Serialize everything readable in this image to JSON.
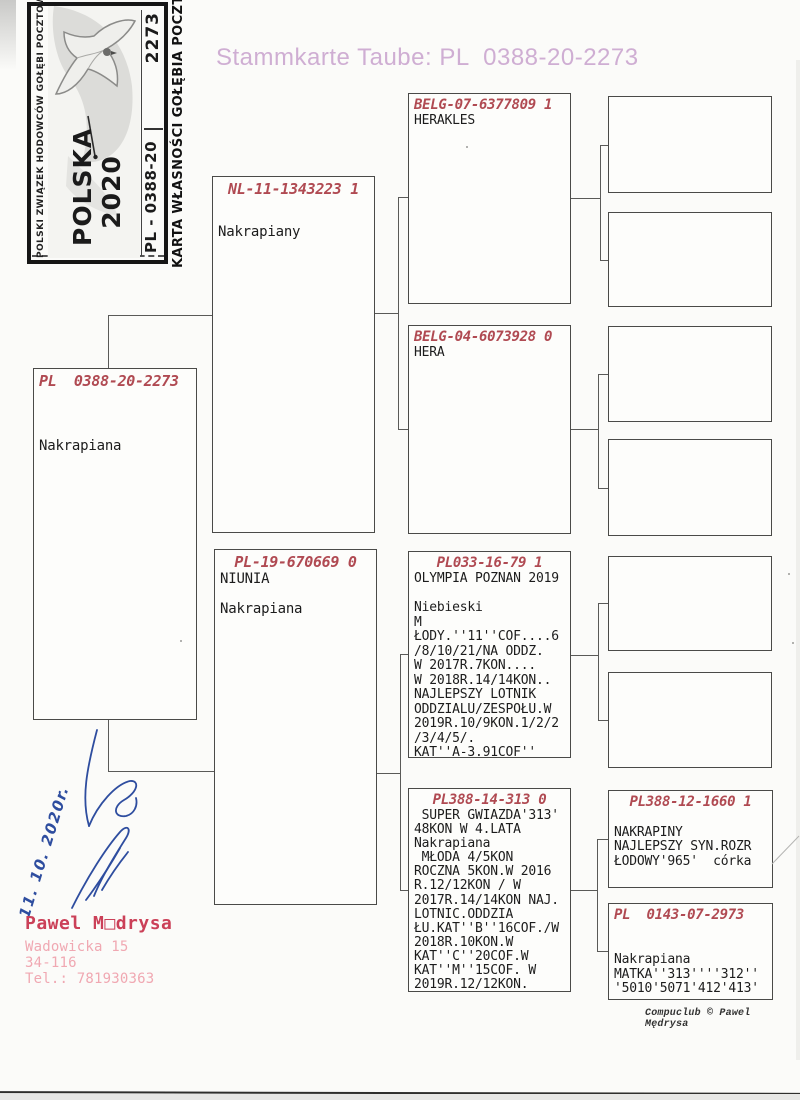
{
  "header": {
    "title": "Stammkarte Taube: PL  0388-20-2273"
  },
  "stamp": {
    "association": "POLSKI ZWIĄZEK HODOWCÓW GOŁĘBI POCZTOWYCH",
    "card_type": "KARTA WŁASNOŚCI GOŁĘBIA POCZTOWEGO",
    "country_year": "POLSKA\n2020",
    "ring_series": "PL - 0388-20",
    "ring_number": "2273"
  },
  "pedigree": {
    "subject": {
      "ring": "PL  0388-20-2273",
      "notes": "Nakrapiana"
    },
    "father": {
      "ring": "NL-11-1343223 1",
      "notes": "Nakrapiany"
    },
    "mother": {
      "ring": "PL-19-670669 0",
      "notes": "NIUNIA\n\nNakrapiana"
    },
    "grandfather_paternal": {
      "ring": "BELG-07-6377809 1",
      "notes": "HERAKLES"
    },
    "grandmother_paternal": {
      "ring": "BELG-04-6073928 0",
      "notes": "HERA"
    },
    "grandfather_maternal": {
      "ring": "PL033-16-79 1",
      "notes": "OLYMPIA POZNAN 2019\n\nNiebieski\nM\nŁODY.''11''COF....6\n/8/10/21/NA ODDZ.\nW 2017R.7KON....\nW 2018R.14/14KON..\nNAJLEPSZY LOTNIK\nODDZIALU/ZESPOŁU.W\n2019R.10/9KON.1/2/2\n/3/4/5/.\nKAT''A-3.91COF''"
    },
    "grandmother_maternal": {
      "ring": "PL388-14-313 0",
      "notes": " SUPER GWIAZDA'313'\n48KON W 4.LATA\nNakrapiana\n MŁODA 4/5KON\nROCZNA 5KON.W 2016\nR.12/12KON / W\n2017R.14/14KON NAJ.\nLOTNIC.ODDZIA\nŁU.KAT''B''16COF./W\n2018R.10KON.W\nKAT''C''20COF.W\nKAT''M''15COF. W\n2019R.12/12KON."
    },
    "great_grandfather_maternal": {
      "ring": "PL388-12-1660 1",
      "notes": "\nNAKRAPINY\nNAJLEPSZY SYN.ROZR\nŁODOWY'965'  córka"
    },
    "great_grandmother_maternal": {
      "ring": "PL  0143-07-2973",
      "notes": "\n\nNakrapiana\nMATKA''313''''312''\n'5010'5071'412'413'"
    }
  },
  "signature": {
    "date": "11. 10. 2020r."
  },
  "owner": {
    "name": "Pawel M□drysa",
    "street": "Wadowicka 15",
    "postal_code": "34-116",
    "phone": "Tel.: 781930363"
  },
  "footer": {
    "credit": "Compuclub © Pawel Mędrysa"
  },
  "colors": {
    "ring_red": "#b04a52",
    "title_pink": "#cfaed3",
    "owner_red": "#cb4058",
    "address_pink": "#f0a8b2",
    "ink_blue": "#2e4d9f"
  }
}
